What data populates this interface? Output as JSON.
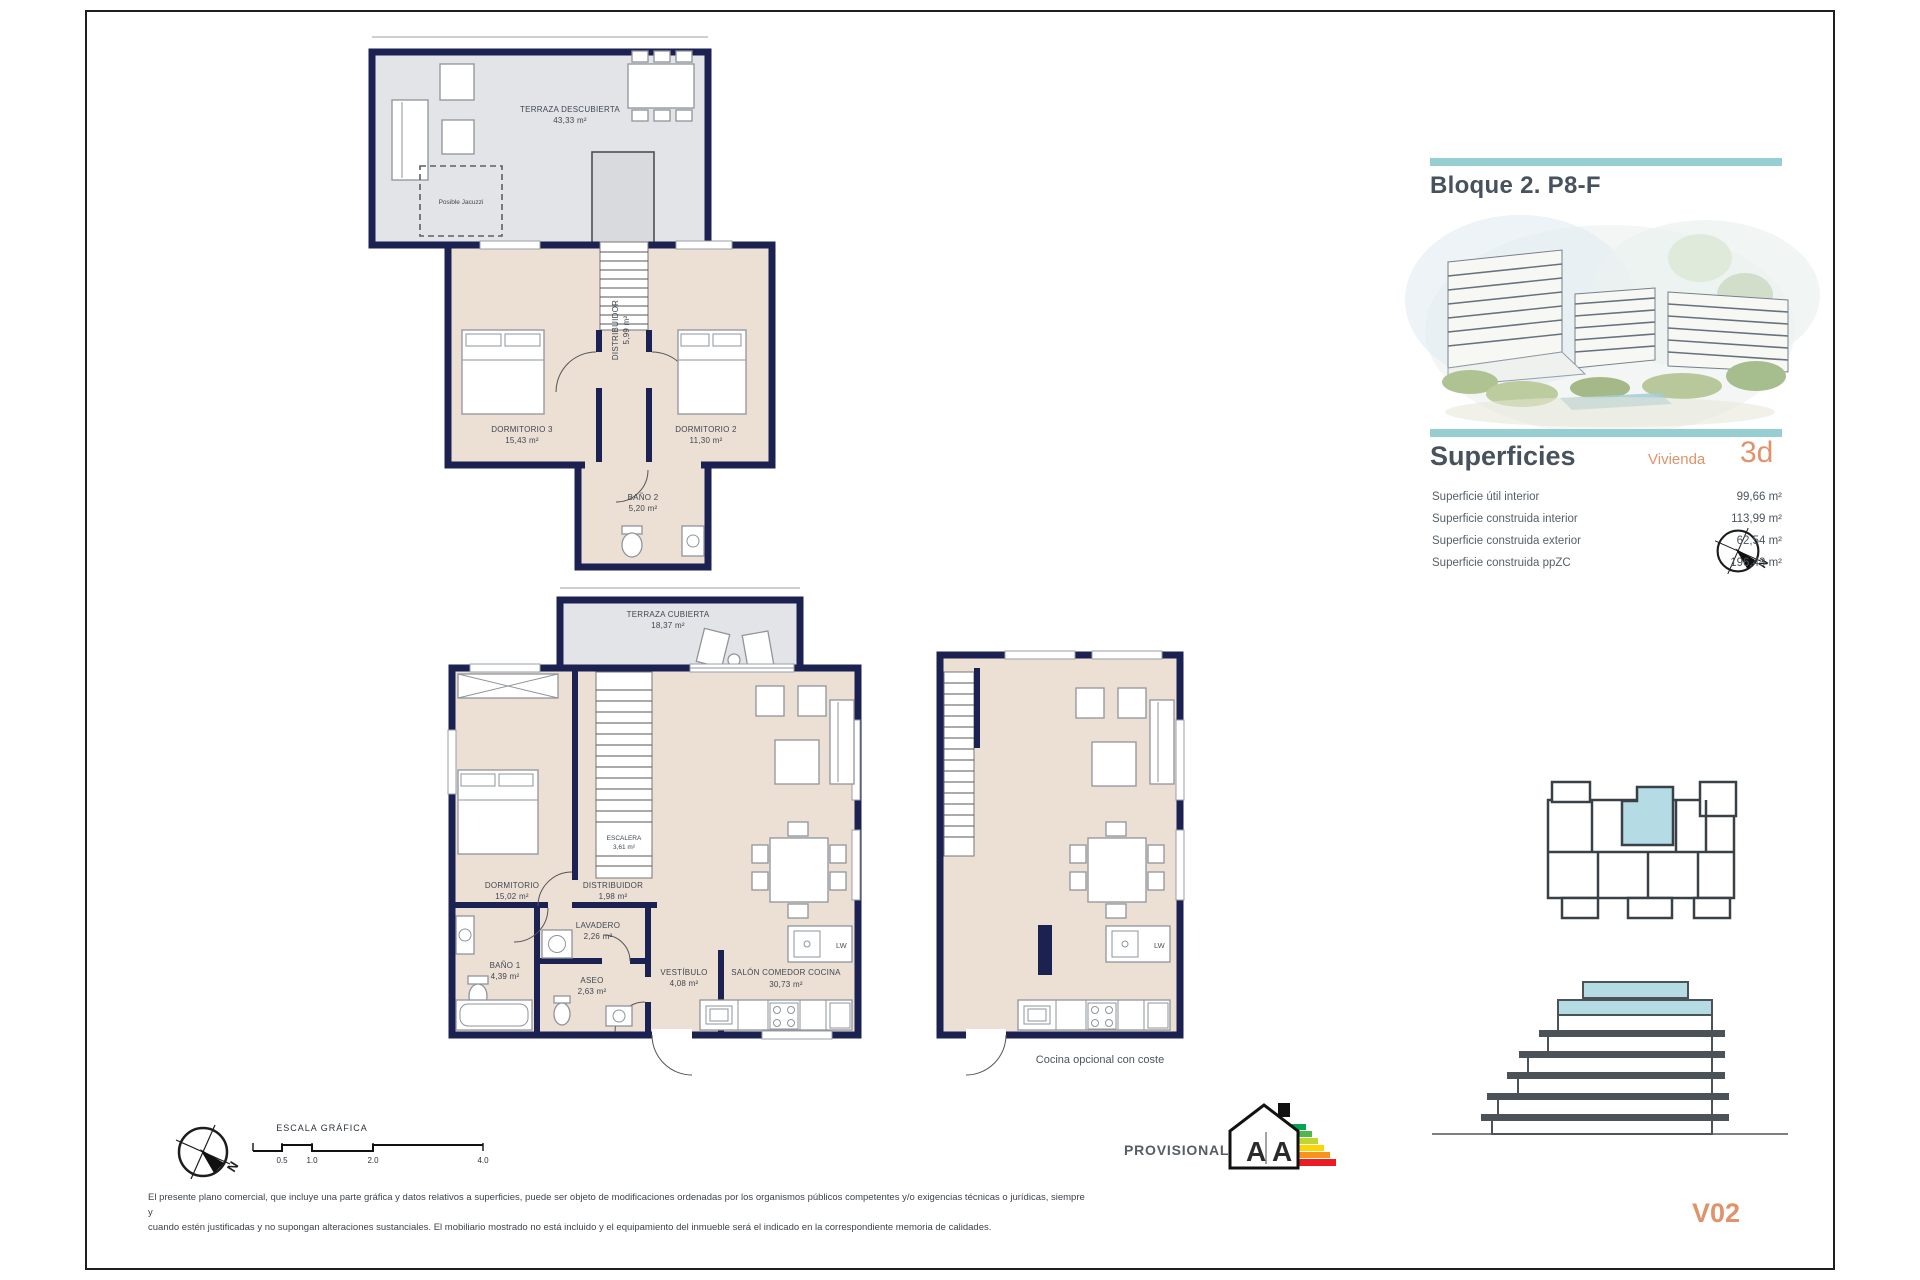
{
  "document": {
    "header": {
      "block_title": "Bloque 2. P8-F"
    },
    "superficies": {
      "title": "Superficies",
      "unit_type_label": "Vivienda",
      "unit_type_value": "3d",
      "rows": [
        {
          "label": "Superficie útil interior",
          "value": "99,66 m²"
        },
        {
          "label": "Superficie construida interior",
          "value": "113,99 m²"
        },
        {
          "label": "Superficie construida exterior",
          "value": "62,54 m²"
        },
        {
          "label": "Superficie construida ppZC",
          "value": "196,43 m²"
        }
      ]
    },
    "version": "V02"
  },
  "plans": {
    "upper_floor": {
      "terraza_descubierta_name": "TERRAZA DESCUBIERTA",
      "terraza_descubierta_area": "43,33 m²",
      "jacuzzi_note": "Posible Jacuzzi",
      "dormitorio3_name": "DORMITORIO 3",
      "dormitorio3_area": "15,43 m²",
      "dormitorio2_name": "DORMITORIO 2",
      "dormitorio2_area": "11,30 m²",
      "distribuidor_name": "DISTRIBUIDOR",
      "distribuidor_area": "5,99 m²",
      "bano2_name": "BAÑO 2",
      "bano2_area": "5,20 m²"
    },
    "main_floor": {
      "terraza_cubierta_name": "TERRAZA CUBIERTA",
      "terraza_cubierta_area": "18,37 m²",
      "dormitorio_name": "DORMITORIO",
      "dormitorio_area": "15,02 m²",
      "escalera_name": "ESCALERA",
      "escalera_area": "3,61 m²",
      "distribuidor_name": "DISTRIBUIDOR",
      "distribuidor_area": "1,98 m²",
      "lavadero_name": "LAVADERO",
      "lavadero_area": "2,26 m²",
      "bano1_name": "BAÑO 1",
      "bano1_area": "4,39 m²",
      "aseo_name": "ASEO",
      "aseo_area": "2,63 m²",
      "vestibulo_name": "VESTÍBULO",
      "vestibulo_area": "4,08 m²",
      "salon_name": "SALÓN COMEDOR COCINA",
      "salon_area": "30,73 m²",
      "dishwasher_label": "LW"
    },
    "kitchen_variant": {
      "caption": "Cocina opcional con coste",
      "dishwasher_label": "LW"
    }
  },
  "footer": {
    "scale_title": "ESCALA GRÁFICA",
    "scale_ticks": [
      "0.5",
      "1.0",
      "2.0",
      "4.0"
    ],
    "provisional_label": "PROVISIONAL",
    "energy_rating_left": "A",
    "energy_rating_right": "A",
    "north_letter": "N",
    "disclaimer_line1": "El presente plano comercial, que incluye una parte gráfica y datos relativos a superficies, puede ser objeto de modificaciones ordenadas por los organismos públicos competentes y/o exigencias técnicas o jurídicas, siempre y",
    "disclaimer_line2": "cuando estén justificadas y no supongan alteraciones sustanciales. El mobiliario mostrado no está incluido y el equipamiento del inmueble será el indicado en la correspondiente memoria de calidades."
  },
  "colors": {
    "wall_navy": "#1b2150",
    "room_beige": "#ecdfd3",
    "terrace_gray": "#e3e4e7",
    "accent_teal": "#96ced2",
    "accent_orange": "#e0936b",
    "title_slate": "#47525e",
    "highlight_blue": "#b5dbe4"
  }
}
